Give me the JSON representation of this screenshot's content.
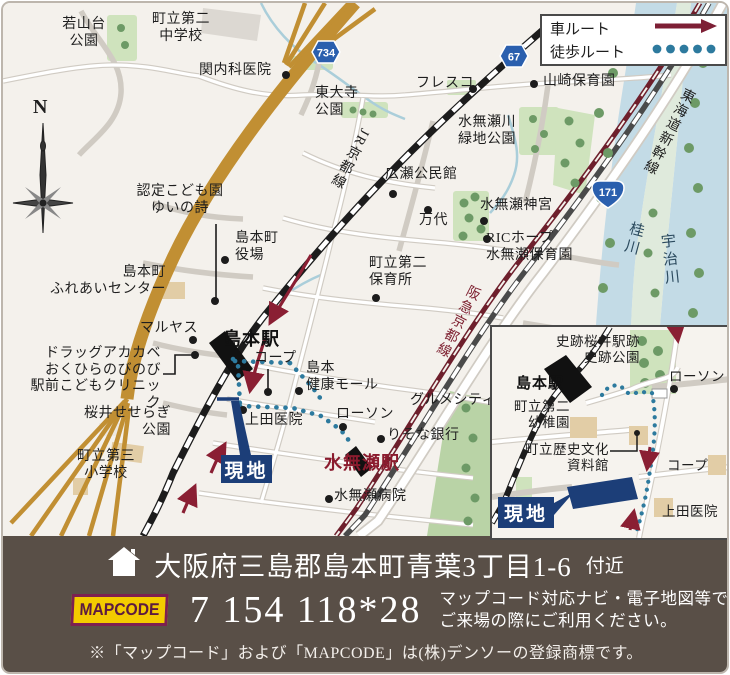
{
  "legend": {
    "car_label": "車ルート",
    "walk_label": "徒歩ルート"
  },
  "map": {
    "compass": "N",
    "shields": {
      "s734": "734",
      "s67": "67",
      "s171": "171"
    },
    "rail_labels": {
      "jr": "JR京都線",
      "hankyu": "阪急京都線",
      "shinkansen": "東海道新幹線"
    },
    "rivers": {
      "katsura": "桂川",
      "uji": "宇治川"
    },
    "site_label": "現地",
    "places": {
      "wakayamadai": {
        "text": "若山台\n公園"
      },
      "chugakko2": {
        "text": "町立第二\n中学校"
      },
      "sekinaika": {
        "text": "関内科医院"
      },
      "todaiji": {
        "text": "東大寺\n公園"
      },
      "fresco": {
        "text": "フレスコ"
      },
      "yamazaki": {
        "text": "山崎保育園"
      },
      "ryokuchi": {
        "text": "水無瀬川\n緑地公園"
      },
      "hirose": {
        "text": "広瀬公民館"
      },
      "jingu": {
        "text": "水無瀬神宮"
      },
      "mandai": {
        "text": "万代"
      },
      "ric": {
        "text": "RICホープ\n水無瀬保育園"
      },
      "hoikusho2": {
        "text": "町立第二\n保育所"
      },
      "nintei": {
        "text": "認定こども園\nゆいの詩"
      },
      "yakuba": {
        "text": "島本町\n役場"
      },
      "fureai": {
        "text": "島本町\nふれあいセンター"
      },
      "maruyasu": {
        "text": "マルヤス"
      },
      "drug": {
        "text": "ドラッグアカカベ\nおくひらのびのび\n駅前こどもクリニック"
      },
      "sakurai": {
        "text": "桜井せせらぎ\n公園"
      },
      "shogakko3": {
        "text": "町立第三\n小学校"
      },
      "shimamoto_sta": {
        "text": "島本駅"
      },
      "coop": {
        "text": "コープ"
      },
      "kenko_mall": {
        "text": "島本\n健康モール"
      },
      "lawson": {
        "text": "ローソン"
      },
      "ueda": {
        "text": "上田医院"
      },
      "gourmet": {
        "text": "グルメシティ"
      },
      "risona": {
        "text": "りそな銀行"
      },
      "minase_sta": {
        "text": "水無瀬駅"
      },
      "minase_hosp": {
        "text": "水無瀬病院"
      }
    }
  },
  "inset": {
    "site_label": "現地",
    "places": {
      "shiseki": {
        "text": "史跡桜井駅跡\n史跡公園"
      },
      "shimamoto_sta": {
        "text": "島本駅"
      },
      "yochien": {
        "text": "町立第二\n幼稚園"
      },
      "rekishi": {
        "text": "町立歴史文化\n資料館"
      },
      "lawson": {
        "text": "ローソン"
      },
      "coop": {
        "text": "コープ"
      },
      "ueda": {
        "text": "上田医院"
      }
    }
  },
  "footer": {
    "address": "大阪府三島郡島本町青葉3丁目1-6",
    "address_suffix": "付近",
    "mapcode_logo": "MAPCODE",
    "mapcode": "7 154 118*28",
    "usage_line1": "マップコード対応ナビ・電子地図等で",
    "usage_line2": "ご来場の際にご利用ください。",
    "trademark_note": "※「マップコード」および「MAPCODE」は(株)デンソーの登録商標です。"
  },
  "colors": {
    "site_navy": "#1c3e78",
    "car_route": "#8a1f33",
    "walk_route": "#2d7a9e",
    "highway": "#c18f33",
    "hankyu": "#6e1f2c",
    "bar_bg": "#594f47",
    "mapcode_yellow": "#f3cb00"
  }
}
